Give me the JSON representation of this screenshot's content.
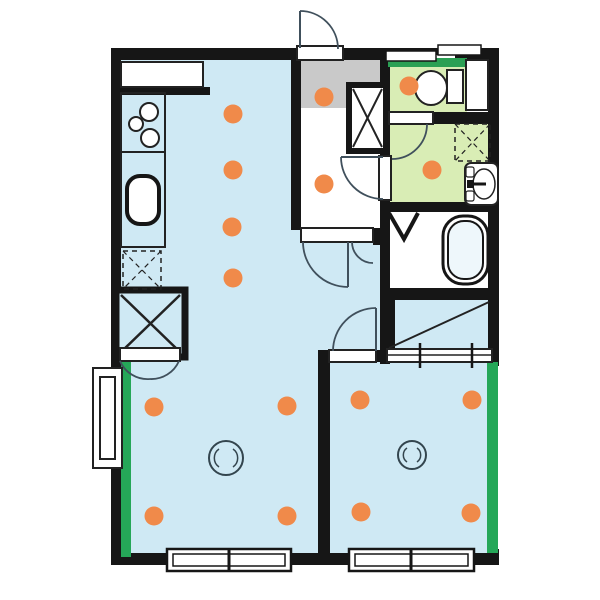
{
  "canvas": {
    "width": 600,
    "height": 600,
    "background": "#ffffff"
  },
  "colors": {
    "wall": "#161616",
    "floor_blue": "#cfe9f4",
    "floor_gray": "#c9c9c9",
    "floor_green": "#d9edb5",
    "floor_white": "#ffffff",
    "window_green": "#25a758",
    "window_bar_green": "#2ba054",
    "marker_orange": "#f08a4a",
    "door_line": "#40505c",
    "detail_line": "#222222",
    "light_line": "#33454e",
    "tub_fill": "#eef7fb"
  },
  "shapes": [
    {
      "name": "base-floor",
      "type": "rect",
      "x": 111,
      "y": 48,
      "w": 388,
      "h": 517,
      "fill": "floor_white"
    },
    {
      "name": "living-dining-kitchen-floor",
      "type": "rect",
      "x": 121,
      "y": 60,
      "w": 180,
      "h": 499,
      "fill": "floor_blue"
    },
    {
      "name": "living-floor-extension-upper",
      "type": "rect",
      "x": 301,
      "y": 240,
      "w": 84,
      "h": 113,
      "fill": "floor_blue"
    },
    {
      "name": "living-floor-extension-lower",
      "type": "rect",
      "x": 301,
      "y": 353,
      "w": 19,
      "h": 206,
      "fill": "floor_blue"
    },
    {
      "name": "bedroom-floor",
      "type": "rect",
      "x": 330,
      "y": 353,
      "w": 158,
      "h": 206,
      "fill": "floor_blue"
    },
    {
      "name": "closet-floor",
      "type": "rect",
      "x": 385,
      "y": 298,
      "w": 107,
      "h": 51,
      "fill": "floor_blue"
    },
    {
      "name": "genkan-entry-floor",
      "type": "rect",
      "x": 301,
      "y": 58,
      "w": 89,
      "h": 52,
      "fill": "floor_gray"
    },
    {
      "name": "hall-floor",
      "type": "rect",
      "x": 301,
      "y": 108,
      "w": 79,
      "h": 134,
      "fill": "floor_white"
    },
    {
      "name": "toilet-room-floor",
      "type": "rect",
      "x": 388,
      "y": 58,
      "w": 79,
      "h": 56,
      "fill": "floor_green"
    },
    {
      "name": "washroom-floor",
      "type": "rect",
      "x": 388,
      "y": 112,
      "w": 102,
      "h": 92,
      "fill": "floor_green"
    },
    {
      "name": "bathroom-floor",
      "type": "rect",
      "x": 388,
      "y": 210,
      "w": 102,
      "h": 80,
      "fill": "floor_white"
    },
    {
      "name": "wall-top-left",
      "type": "rect",
      "x": 111,
      "y": 48,
      "w": 190,
      "h": 12,
      "fill": "wall"
    },
    {
      "name": "wall-top-mid",
      "type": "rect",
      "x": 340,
      "y": 48,
      "w": 50,
      "h": 12,
      "fill": "wall"
    },
    {
      "name": "wall-top-window-back",
      "type": "rect",
      "x": 386,
      "y": 48,
      "w": 72,
      "h": 7,
      "fill": "wall"
    },
    {
      "name": "wall-top-right",
      "type": "rect",
      "x": 455,
      "y": 48,
      "w": 44,
      "h": 12,
      "fill": "wall"
    },
    {
      "name": "wall-left",
      "type": "rect",
      "x": 111,
      "y": 48,
      "w": 10,
      "h": 517,
      "fill": "wall"
    },
    {
      "name": "wall-bottom",
      "type": "rect",
      "x": 111,
      "y": 553,
      "w": 388,
      "h": 12,
      "fill": "wall"
    },
    {
      "name": "wall-right-upper",
      "type": "rect",
      "x": 488,
      "y": 48,
      "w": 11,
      "h": 318,
      "fill": "wall"
    },
    {
      "name": "wall-right-bottom-corner",
      "type": "rect",
      "x": 488,
      "y": 549,
      "w": 11,
      "h": 16,
      "fill": "wall"
    },
    {
      "name": "wall-hall-left",
      "type": "rect",
      "x": 291,
      "y": 48,
      "w": 10,
      "h": 182,
      "fill": "wall"
    },
    {
      "name": "wall-hall-right-upper",
      "type": "rect",
      "x": 380,
      "y": 58,
      "w": 10,
      "h": 100,
      "fill": "wall"
    },
    {
      "name": "wall-hall-right-lower",
      "type": "rect",
      "x": 380,
      "y": 198,
      "w": 10,
      "h": 166,
      "fill": "wall"
    },
    {
      "name": "wall-sill-stub",
      "type": "rect",
      "x": 373,
      "y": 228,
      "w": 17,
      "h": 17,
      "fill": "wall"
    },
    {
      "name": "wall-toilet-bottom",
      "type": "rect",
      "x": 429,
      "y": 112,
      "w": 63,
      "h": 12,
      "fill": "wall"
    },
    {
      "name": "wall-washroom-bathroom",
      "type": "rect",
      "x": 380,
      "y": 202,
      "w": 112,
      "h": 10,
      "fill": "wall"
    },
    {
      "name": "wall-bathroom-closet",
      "type": "rect",
      "x": 383,
      "y": 288,
      "w": 109,
      "h": 12,
      "fill": "wall"
    },
    {
      "name": "wall-closet-left",
      "type": "rect",
      "x": 383,
      "y": 288,
      "w": 12,
      "h": 74,
      "fill": "wall"
    },
    {
      "name": "wall-bedroom-living",
      "type": "rect",
      "x": 318,
      "y": 350,
      "w": 12,
      "h": 215,
      "fill": "wall"
    },
    {
      "name": "wall-bedroom-door-stub",
      "type": "rect",
      "x": 374,
      "y": 350,
      "w": 14,
      "h": 12,
      "fill": "wall"
    },
    {
      "name": "wall-kitchen-stub",
      "type": "rect",
      "x": 121,
      "y": 87,
      "w": 89,
      "h": 8,
      "fill": "wall"
    },
    {
      "name": "window-left-strip",
      "type": "rect",
      "x": 121,
      "y": 353,
      "w": 10,
      "h": 204,
      "fill": "window_green"
    },
    {
      "name": "window-right-strip",
      "type": "rect",
      "x": 487,
      "y": 362,
      "w": 11,
      "h": 191,
      "fill": "window_green"
    },
    {
      "name": "window-toilet-bar",
      "type": "rect",
      "x": 388,
      "y": 58,
      "w": 79,
      "h": 9,
      "fill": "window_bar_green"
    },
    {
      "name": "window-top-pane-left",
      "type": "rect",
      "x": 386,
      "y": 51,
      "w": 50,
      "h": 10,
      "fill": "floor_white",
      "stroke": "wall",
      "sw": 1.5
    },
    {
      "name": "window-top-pane-right",
      "type": "rect",
      "x": 438,
      "y": 45,
      "w": 43,
      "h": 10,
      "fill": "floor_white",
      "stroke": "wall",
      "sw": 1.5
    },
    {
      "name": "pipe-shaft-box",
      "type": "rect",
      "x": 349,
      "y": 85,
      "w": 37,
      "h": 66,
      "fill": "floor_white",
      "stroke": "wall",
      "sw": 6
    },
    {
      "name": "pipe-shaft-x",
      "type": "path",
      "d": "M353,89 L382,147 M382,89 L353,147",
      "stroke": "detail_line",
      "sw": 2
    },
    {
      "name": "storage-closet-box",
      "type": "rect",
      "x": 116,
      "y": 290,
      "w": 69,
      "h": 67,
      "fill": "floor_blue",
      "stroke": "wall",
      "sw": 7
    },
    {
      "name": "storage-closet-x",
      "type": "path",
      "d": "M121,295 L180,352 M180,295 L121,352",
      "stroke": "detail_line",
      "sw": 2.5
    },
    {
      "name": "toilet-side-niche",
      "type": "rect",
      "x": 466,
      "y": 60,
      "w": 22,
      "h": 50,
      "fill": "floor_white",
      "stroke": "detail_line",
      "sw": 2
    },
    {
      "name": "entrance-door-sill",
      "type": "rect",
      "x": 297,
      "y": 46,
      "w": 46,
      "h": 14,
      "fill": "floor_white",
      "stroke": "detail_line",
      "sw": 2
    },
    {
      "name": "hall-living-door-sill",
      "type": "rect",
      "x": 301,
      "y": 228,
      "w": 72,
      "h": 14,
      "fill": "floor_white",
      "stroke": "detail_line",
      "sw": 2
    },
    {
      "name": "washroom-door-sill",
      "type": "rect",
      "x": 379,
      "y": 156,
      "w": 12,
      "h": 44,
      "fill": "floor_white",
      "stroke": "detail_line",
      "sw": 2
    },
    {
      "name": "toilet-door-sill",
      "type": "rect",
      "x": 389,
      "y": 112,
      "w": 44,
      "h": 12,
      "fill": "floor_white",
      "stroke": "detail_line",
      "sw": 2
    },
    {
      "name": "closet-door-sill",
      "type": "rect",
      "x": 120,
      "y": 348,
      "w": 60,
      "h": 13,
      "fill": "floor_white",
      "stroke": "detail_line",
      "sw": 2
    },
    {
      "name": "bedroom-door-sill",
      "type": "rect",
      "x": 329,
      "y": 350,
      "w": 47,
      "h": 12,
      "fill": "floor_white",
      "stroke": "detail_line",
      "sw": 2
    },
    {
      "name": "entrance-door-leaf",
      "type": "path",
      "d": "M300,11 L300,48",
      "stroke": "door_line",
      "sw": 2
    },
    {
      "name": "entrance-door-arc",
      "type": "path",
      "d": "M300,11 A38,38 0 0 1 338,49",
      "stroke": "door_line",
      "sw": 1.8
    },
    {
      "name": "hall-living-door-leaf",
      "type": "path",
      "d": "M348,242 L348,287",
      "stroke": "door_line",
      "sw": 2
    },
    {
      "name": "hall-living-door-arc",
      "type": "path",
      "d": "M303,242 A45,45 0 0 0 348,287",
      "stroke": "door_line",
      "sw": 1.8
    },
    {
      "name": "hall-living-child-door-arc",
      "type": "path",
      "d": "M352,242 A21,21 0 0 0 373,263",
      "stroke": "door_line",
      "sw": 1.8
    },
    {
      "name": "washroom-door-leaf",
      "type": "path",
      "d": "M341,157 L383,157",
      "stroke": "door_line",
      "sw": 2
    },
    {
      "name": "washroom-door-arc",
      "type": "path",
      "d": "M341,157 A42,42 0 0 0 383,199",
      "stroke": "door_line",
      "sw": 1.8
    },
    {
      "name": "toilet-door-arc",
      "type": "path",
      "d": "M427,124 A35,35 0 0 1 392,159",
      "stroke": "door_line",
      "sw": 1.8
    },
    {
      "name": "bedroom-door-leaf",
      "type": "path",
      "d": "M376,308 L376,351",
      "stroke": "door_line",
      "sw": 2
    },
    {
      "name": "bedroom-door-arc",
      "type": "path",
      "d": "M376,308 A43,43 0 0 0 333,351",
      "stroke": "door_line",
      "sw": 1.8
    },
    {
      "name": "closet-door-arc-left",
      "type": "path",
      "d": "M120,361 A30,30 0 0 0 150,379",
      "stroke": "door_line",
      "sw": 1.8
    },
    {
      "name": "closet-door-arc-right",
      "type": "path",
      "d": "M179,361 A30,30 0 0 1 150,379",
      "stroke": "door_line",
      "sw": 1.8
    },
    {
      "name": "bathroom-fold-door",
      "type": "path",
      "d": "M389,213 L404,239 L418,213",
      "stroke": "wall",
      "sw": 4
    },
    {
      "name": "kitchen-counter-top",
      "type": "rect",
      "x": 121,
      "y": 62,
      "w": 82,
      "h": 25,
      "fill": "floor_white",
      "stroke": "detail_line",
      "sw": 2
    },
    {
      "name": "stove-counter",
      "type": "rect",
      "x": 121,
      "y": 93,
      "w": 44,
      "h": 59,
      "stroke": "detail_line",
      "sw": 2
    },
    {
      "name": "sink-counter",
      "type": "rect",
      "x": 121,
      "y": 152,
      "w": 44,
      "h": 95,
      "stroke": "detail_line",
      "sw": 2
    },
    {
      "name": "stove-burner-1",
      "type": "circle",
      "cx": 149,
      "cy": 112,
      "r": 9,
      "fill": "floor_white",
      "stroke": "detail_line",
      "sw": 2
    },
    {
      "name": "stove-burner-2",
      "type": "circle",
      "cx": 136,
      "cy": 124,
      "r": 7,
      "fill": "floor_white",
      "stroke": "detail_line",
      "sw": 2
    },
    {
      "name": "stove-burner-3",
      "type": "circle",
      "cx": 150,
      "cy": 138,
      "r": 9,
      "fill": "floor_white",
      "stroke": "detail_line",
      "sw": 2
    },
    {
      "name": "kitchen-sink",
      "type": "rect",
      "x": 127,
      "y": 176,
      "w": 32,
      "h": 48,
      "rx": 13,
      "fill": "floor_white",
      "stroke": "wall",
      "sw": 4
    },
    {
      "name": "refrigerator-space",
      "type": "rect",
      "x": 123,
      "y": 251,
      "w": 38,
      "h": 38,
      "stroke": "detail_line",
      "sw": 1.5,
      "dash": "5,4"
    },
    {
      "name": "refrigerator-space-x",
      "type": "path",
      "d": "M123,251 L161,289 M161,251 L123,289",
      "stroke": "detail_line",
      "sw": 1.2,
      "dash": "5,4"
    },
    {
      "name": "washing-machine-pan",
      "type": "rect",
      "x": 455,
      "y": 124,
      "w": 35,
      "h": 37,
      "stroke": "detail_line",
      "sw": 1.5,
      "dash": "5,4"
    },
    {
      "name": "washing-machine-pan-x",
      "type": "path",
      "d": "M455,124 L490,161 M490,124 L455,161",
      "stroke": "detail_line",
      "sw": 1.2,
      "dash": "5,4"
    },
    {
      "name": "toilet-tank",
      "type": "rect",
      "x": 447,
      "y": 70,
      "w": 16,
      "h": 33,
      "fill": "floor_white",
      "stroke": "detail_line",
      "sw": 2
    },
    {
      "name": "toilet-bowl",
      "type": "ellipse",
      "cx": 431,
      "cy": 88,
      "rx": 16,
      "ry": 17,
      "fill": "floor_white",
      "stroke": "detail_line",
      "sw": 2
    },
    {
      "name": "washbasin-body",
      "type": "rect",
      "x": 465,
      "y": 163,
      "w": 33,
      "h": 42,
      "rx": 6,
      "fill": "floor_white",
      "stroke": "detail_line",
      "sw": 2
    },
    {
      "name": "washbasin-bowl",
      "type": "ellipse",
      "cx": 484,
      "cy": 184,
      "rx": 11,
      "ry": 15,
      "stroke": "detail_line",
      "sw": 1.5
    },
    {
      "name": "washbasin-faucet",
      "type": "path",
      "d": "M468,184 L486,184",
      "stroke": "wall",
      "sw": 3
    },
    {
      "name": "washbasin-faucet-knob",
      "type": "rect",
      "x": 467,
      "y": 180,
      "w": 7,
      "h": 8,
      "fill": "wall"
    },
    {
      "name": "washbasin-tray-upper",
      "type": "rect",
      "x": 466,
      "y": 167,
      "w": 8,
      "h": 10,
      "rx": 2,
      "fill": "floor_white",
      "stroke": "detail_line",
      "sw": 1.2
    },
    {
      "name": "washbasin-tray-lower",
      "type": "rect",
      "x": 466,
      "y": 191,
      "w": 8,
      "h": 10,
      "rx": 2,
      "fill": "floor_white",
      "stroke": "detail_line",
      "sw": 1.2
    },
    {
      "name": "bathtub-outer",
      "type": "rect",
      "x": 443,
      "y": 216,
      "w": 45,
      "h": 68,
      "rx": 20,
      "stroke": "wall",
      "sw": 3
    },
    {
      "name": "bathtub-inner",
      "type": "rect",
      "x": 448,
      "y": 221,
      "w": 35,
      "h": 58,
      "rx": 16,
      "fill": "tub_fill",
      "stroke": "wall",
      "sw": 2
    },
    {
      "name": "closet-diagonal-mark",
      "type": "path",
      "d": "M389,348 L489,302",
      "stroke": "detail_line",
      "sw": 2
    },
    {
      "name": "closet-slider-track",
      "type": "rect",
      "x": 387,
      "y": 349,
      "w": 105,
      "h": 13,
      "fill": "floor_white",
      "stroke": "detail_line",
      "sw": 2
    },
    {
      "name": "closet-slider-midline",
      "type": "path",
      "d": "M387,355 L492,355",
      "stroke": "detail_line",
      "sw": 1.5
    },
    {
      "name": "closet-slider-tick-1",
      "type": "path",
      "d": "M420,343 L420,368",
      "stroke": "wall",
      "sw": 2.5
    },
    {
      "name": "closet-slider-tick-2",
      "type": "path",
      "d": "M472,343 L472,368",
      "stroke": "wall",
      "sw": 2.5
    },
    {
      "name": "left-bay-outer-frame",
      "type": "rect",
      "x": 93,
      "y": 368,
      "w": 29,
      "h": 100,
      "fill": "floor_white",
      "stroke": "detail_line",
      "sw": 2
    },
    {
      "name": "left-bay-inner-frame",
      "type": "rect",
      "x": 100,
      "y": 377,
      "w": 15,
      "h": 82,
      "fill": "floor_white",
      "stroke": "detail_line",
      "sw": 2
    },
    {
      "name": "window-bottom-left-outer",
      "type": "rect",
      "x": 167,
      "y": 549,
      "w": 124,
      "h": 22,
      "fill": "floor_white",
      "stroke": "wall",
      "sw": 2.5
    },
    {
      "name": "window-bottom-left-inner",
      "type": "rect",
      "x": 173,
      "y": 554,
      "w": 112,
      "h": 12,
      "stroke": "wall",
      "sw": 1.5
    },
    {
      "name": "window-bottom-left-divider",
      "type": "path",
      "d": "M229,549 L229,571",
      "stroke": "wall",
      "sw": 3
    },
    {
      "name": "window-bottom-right-outer",
      "type": "rect",
      "x": 349,
      "y": 549,
      "w": 125,
      "h": 22,
      "fill": "floor_white",
      "stroke": "wall",
      "sw": 2.5
    },
    {
      "name": "window-bottom-right-inner",
      "type": "rect",
      "x": 355,
      "y": 554,
      "w": 113,
      "h": 12,
      "stroke": "wall",
      "sw": 1.5
    },
    {
      "name": "window-bottom-right-divider",
      "type": "path",
      "d": "M411,549 L411,571",
      "stroke": "wall",
      "sw": 3
    },
    {
      "name": "ceiling-light-living",
      "type": "circle",
      "cx": 226,
      "cy": 458,
      "r": 17,
      "stroke": "light_line",
      "sw": 2
    },
    {
      "name": "ceiling-light-living-arc-left",
      "type": "path",
      "d": "M219,449 A11,11 0 0 0 219,467",
      "stroke": "light_line",
      "sw": 1.5
    },
    {
      "name": "ceiling-light-living-arc-right",
      "type": "path",
      "d": "M233,449 A11,11 0 0 1 233,467",
      "stroke": "light_line",
      "sw": 1.5
    },
    {
      "name": "ceiling-light-bedroom",
      "type": "circle",
      "cx": 412,
      "cy": 455,
      "r": 14,
      "stroke": "light_line",
      "sw": 2
    },
    {
      "name": "ceiling-light-bedroom-arc-left",
      "type": "path",
      "d": "M407,448 A8.5,8.5 0 0 0 407,462",
      "stroke": "light_line",
      "sw": 1.5
    },
    {
      "name": "ceiling-light-bedroom-arc-right",
      "type": "path",
      "d": "M417,448 A8.5,8.5 0 0 1 417,462",
      "stroke": "light_line",
      "sw": 1.5
    }
  ],
  "markers": {
    "radius": 9.5,
    "color": "marker_orange",
    "points": [
      {
        "x": 233,
        "y": 114
      },
      {
        "x": 233,
        "y": 170
      },
      {
        "x": 232,
        "y": 227
      },
      {
        "x": 233,
        "y": 278
      },
      {
        "x": 324,
        "y": 97
      },
      {
        "x": 324,
        "y": 184
      },
      {
        "x": 409,
        "y": 86
      },
      {
        "x": 432,
        "y": 170
      },
      {
        "x": 154,
        "y": 407
      },
      {
        "x": 287,
        "y": 406
      },
      {
        "x": 154,
        "y": 516
      },
      {
        "x": 287,
        "y": 516
      },
      {
        "x": 360,
        "y": 400
      },
      {
        "x": 472,
        "y": 400
      },
      {
        "x": 361,
        "y": 512
      },
      {
        "x": 471,
        "y": 513
      }
    ]
  }
}
